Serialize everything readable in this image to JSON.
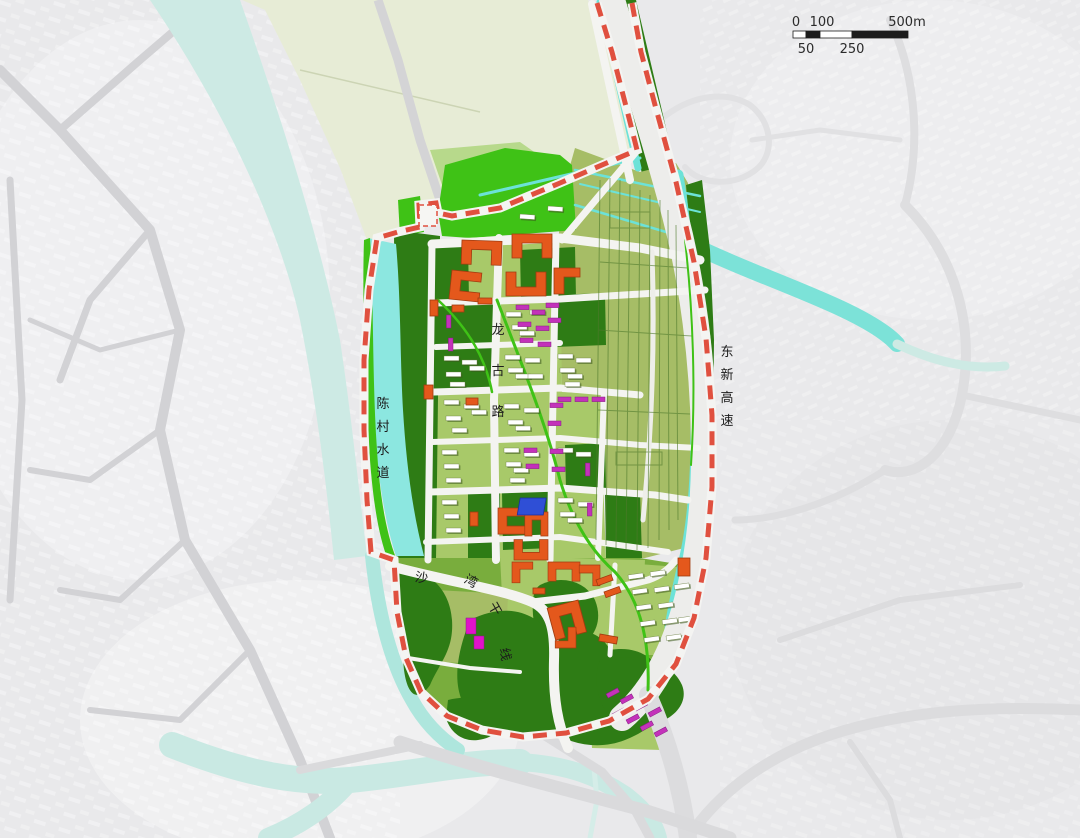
{
  "map": {
    "title": "urban planning land-use map",
    "labels": {
      "river": "陈村水道",
      "expressway": "东新高速",
      "road_center": "龙古路",
      "road_south": "沙湾干线"
    },
    "scalebar": {
      "zero": "0",
      "hundred": "100",
      "five_hundred": "500m",
      "fifty": "50",
      "two_fifty": "250"
    },
    "colors": {
      "background": "#e9e9eb",
      "boundary_red": "#e0503f",
      "park_dark_green": "#2e7c15",
      "park_vivid_green": "#3fc216",
      "block_light_green": "#a8c969",
      "industrial_olive": "#a6bd66",
      "organic_green": "#79ad3d",
      "water_bright_cyan": "#6ce2d8",
      "water_pale_cyan": "#c9e9e3",
      "field_pale": "#e7ecd6",
      "building_orange": "#e4581c",
      "building_magenta": "#c332ba",
      "building_blue": "#2f4fd6",
      "road_white": "#f4f4f1"
    }
  }
}
